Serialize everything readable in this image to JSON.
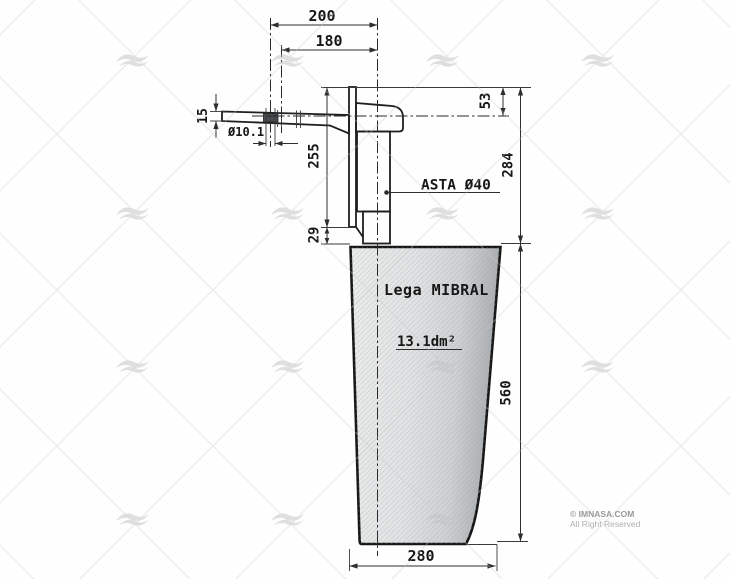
{
  "drawing": {
    "dimensions": {
      "top_width_outer": "200",
      "top_width_inner": "180",
      "tiller_thickness": "15",
      "bolt_hole_diameter": "Ø10.1",
      "stock_upper_height": "255",
      "stock_step_height": "29",
      "head_top_offset": "53",
      "stock_total_height": "284",
      "blade_height": "560",
      "blade_bottom_width": "280"
    },
    "annotations": {
      "shaft_label": "ASTA Ø40",
      "material_label": "Lega MIBRAL",
      "blade_area_label": "13.1dm²"
    }
  },
  "watermark": {
    "logo": "imnasa-waves-icon",
    "copyright_line1": "© IMNASA.COM",
    "copyright_line2": "All Right Reserved"
  }
}
